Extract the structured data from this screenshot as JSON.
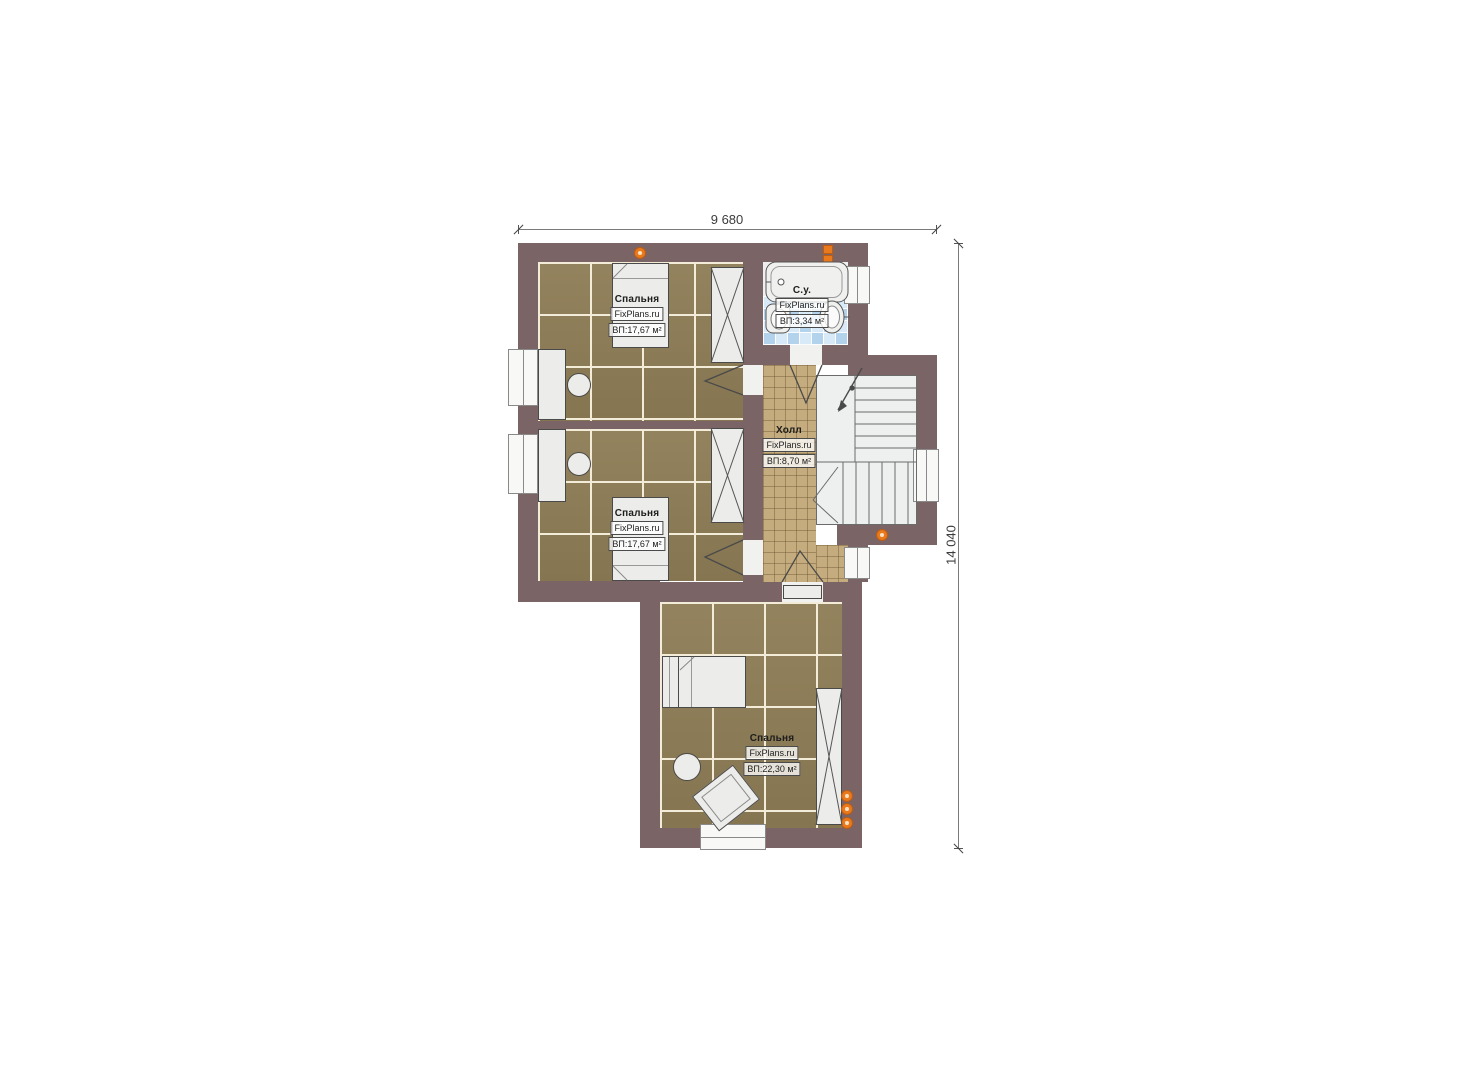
{
  "plan": {
    "dimensions": {
      "width_label": "9 680",
      "height_label": "14 040"
    },
    "rooms": [
      {
        "id": "bedroom-top",
        "name": "Спальня",
        "brand": "FixPlans.ru",
        "area_label": "ВП:17,67 м²"
      },
      {
        "id": "bedroom-middle",
        "name": "Спальня",
        "brand": "FixPlans.ru",
        "area_label": "ВП:17,67 м²"
      },
      {
        "id": "bathroom",
        "name": "С.у.",
        "brand": "FixPlans.ru",
        "area_label": "ВП:3,34 м²"
      },
      {
        "id": "hall",
        "name": "Холл",
        "brand": "FixPlans.ru",
        "area_label": "ВП:8,70 м²"
      },
      {
        "id": "bedroom-bottom",
        "name": "Спальня",
        "brand": "FixPlans.ru",
        "area_label": "ВП:22,30 м²"
      }
    ],
    "colors": {
      "wall": "#7b6465",
      "bedroom_floor": "#8d7c55",
      "hall_floor": "#c4ac7e",
      "bathroom_tile": "#cde2f4",
      "stair_floor": "#eef0f0",
      "marker_orange": "#e8791d"
    }
  }
}
